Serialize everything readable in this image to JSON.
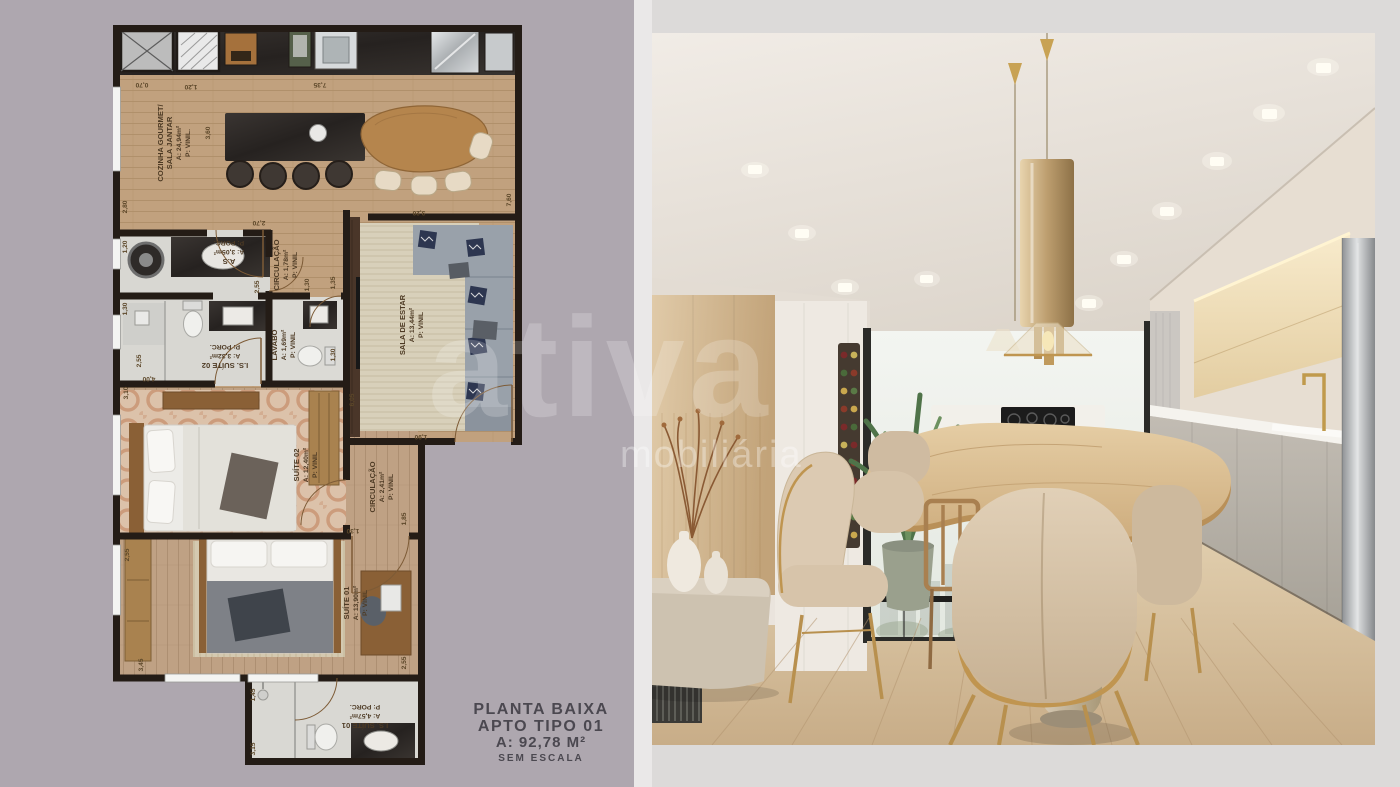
{
  "page": {
    "bg_left_color": "#aea7af",
    "bg_divider_color": "#eae8e8",
    "bg_right_color": "#dcdad9"
  },
  "title_block": {
    "line1": "PLANTA BAIXA",
    "line2": "APTO TIPO 01",
    "line3": "A: 92,78 M²",
    "line4": "SEM ESCALA"
  },
  "watermark": {
    "brand": "ativa",
    "subtitle": "mobiliária"
  },
  "floorplan": {
    "rooms": {
      "cozinha": {
        "name": "COZINHA GOURMET/",
        "name2": "SALA JANTAR",
        "area": "A: 24,94m²",
        "floor": "P: VINIL."
      },
      "as": {
        "name": "A.S",
        "area": "A: 3,05m²",
        "floor": "P: PORC."
      },
      "circ1": {
        "name": "CIRCULAÇÃO",
        "area": "A: 1,78m²",
        "floor": "P: VINIL"
      },
      "lavabo": {
        "name": "LAVABO",
        "area": "A: 1,69m²",
        "floor": "P: VINIL"
      },
      "is2": {
        "name": "I.S. SUÍTE 02",
        "area": "A: 3,32m²",
        "floor": "P: PORC."
      },
      "sala": {
        "name": "SALA DE ESTAR",
        "area": "A: 13,44m²",
        "floor": "P: VINIL"
      },
      "suite2": {
        "name": "SUÍTE 02",
        "area": "A: 12,40m²",
        "floor": "P: VINIL"
      },
      "circ2": {
        "name": "CIRCULAÇÃO",
        "area": "A: 2,41m²",
        "floor": "P: VINIL"
      },
      "suite1": {
        "name": "SUÍTE 01",
        "area": "A: 13,90m²",
        "floor": "P: VINIL"
      },
      "is1": {
        "name": "I.S. SUÍTE 01",
        "area": "A: 4,57m²",
        "floor": "P: PORC."
      }
    },
    "dims": {
      "d070": "0,70",
      "d120t": "1,20",
      "d735": "7,35",
      "d360": "3,60",
      "d280": "2,80",
      "d270": "2,70",
      "d760": "7,60",
      "d320": "3,20",
      "d120l": "1,20",
      "d255as": "2,55",
      "d130l": "1,30",
      "d255l": "2,55",
      "d310": "3,10",
      "d400": "4,00",
      "d130c": "1,30",
      "d135": "1,35",
      "d130lv": "1,30",
      "d605": "6,05",
      "d190": "1,90",
      "d185": "1,85",
      "d130s": "1,30",
      "d255r": "2,55",
      "d255s1": "2,55",
      "d345": "3,45",
      "d145": "1,45",
      "d315": "3,15"
    }
  }
}
